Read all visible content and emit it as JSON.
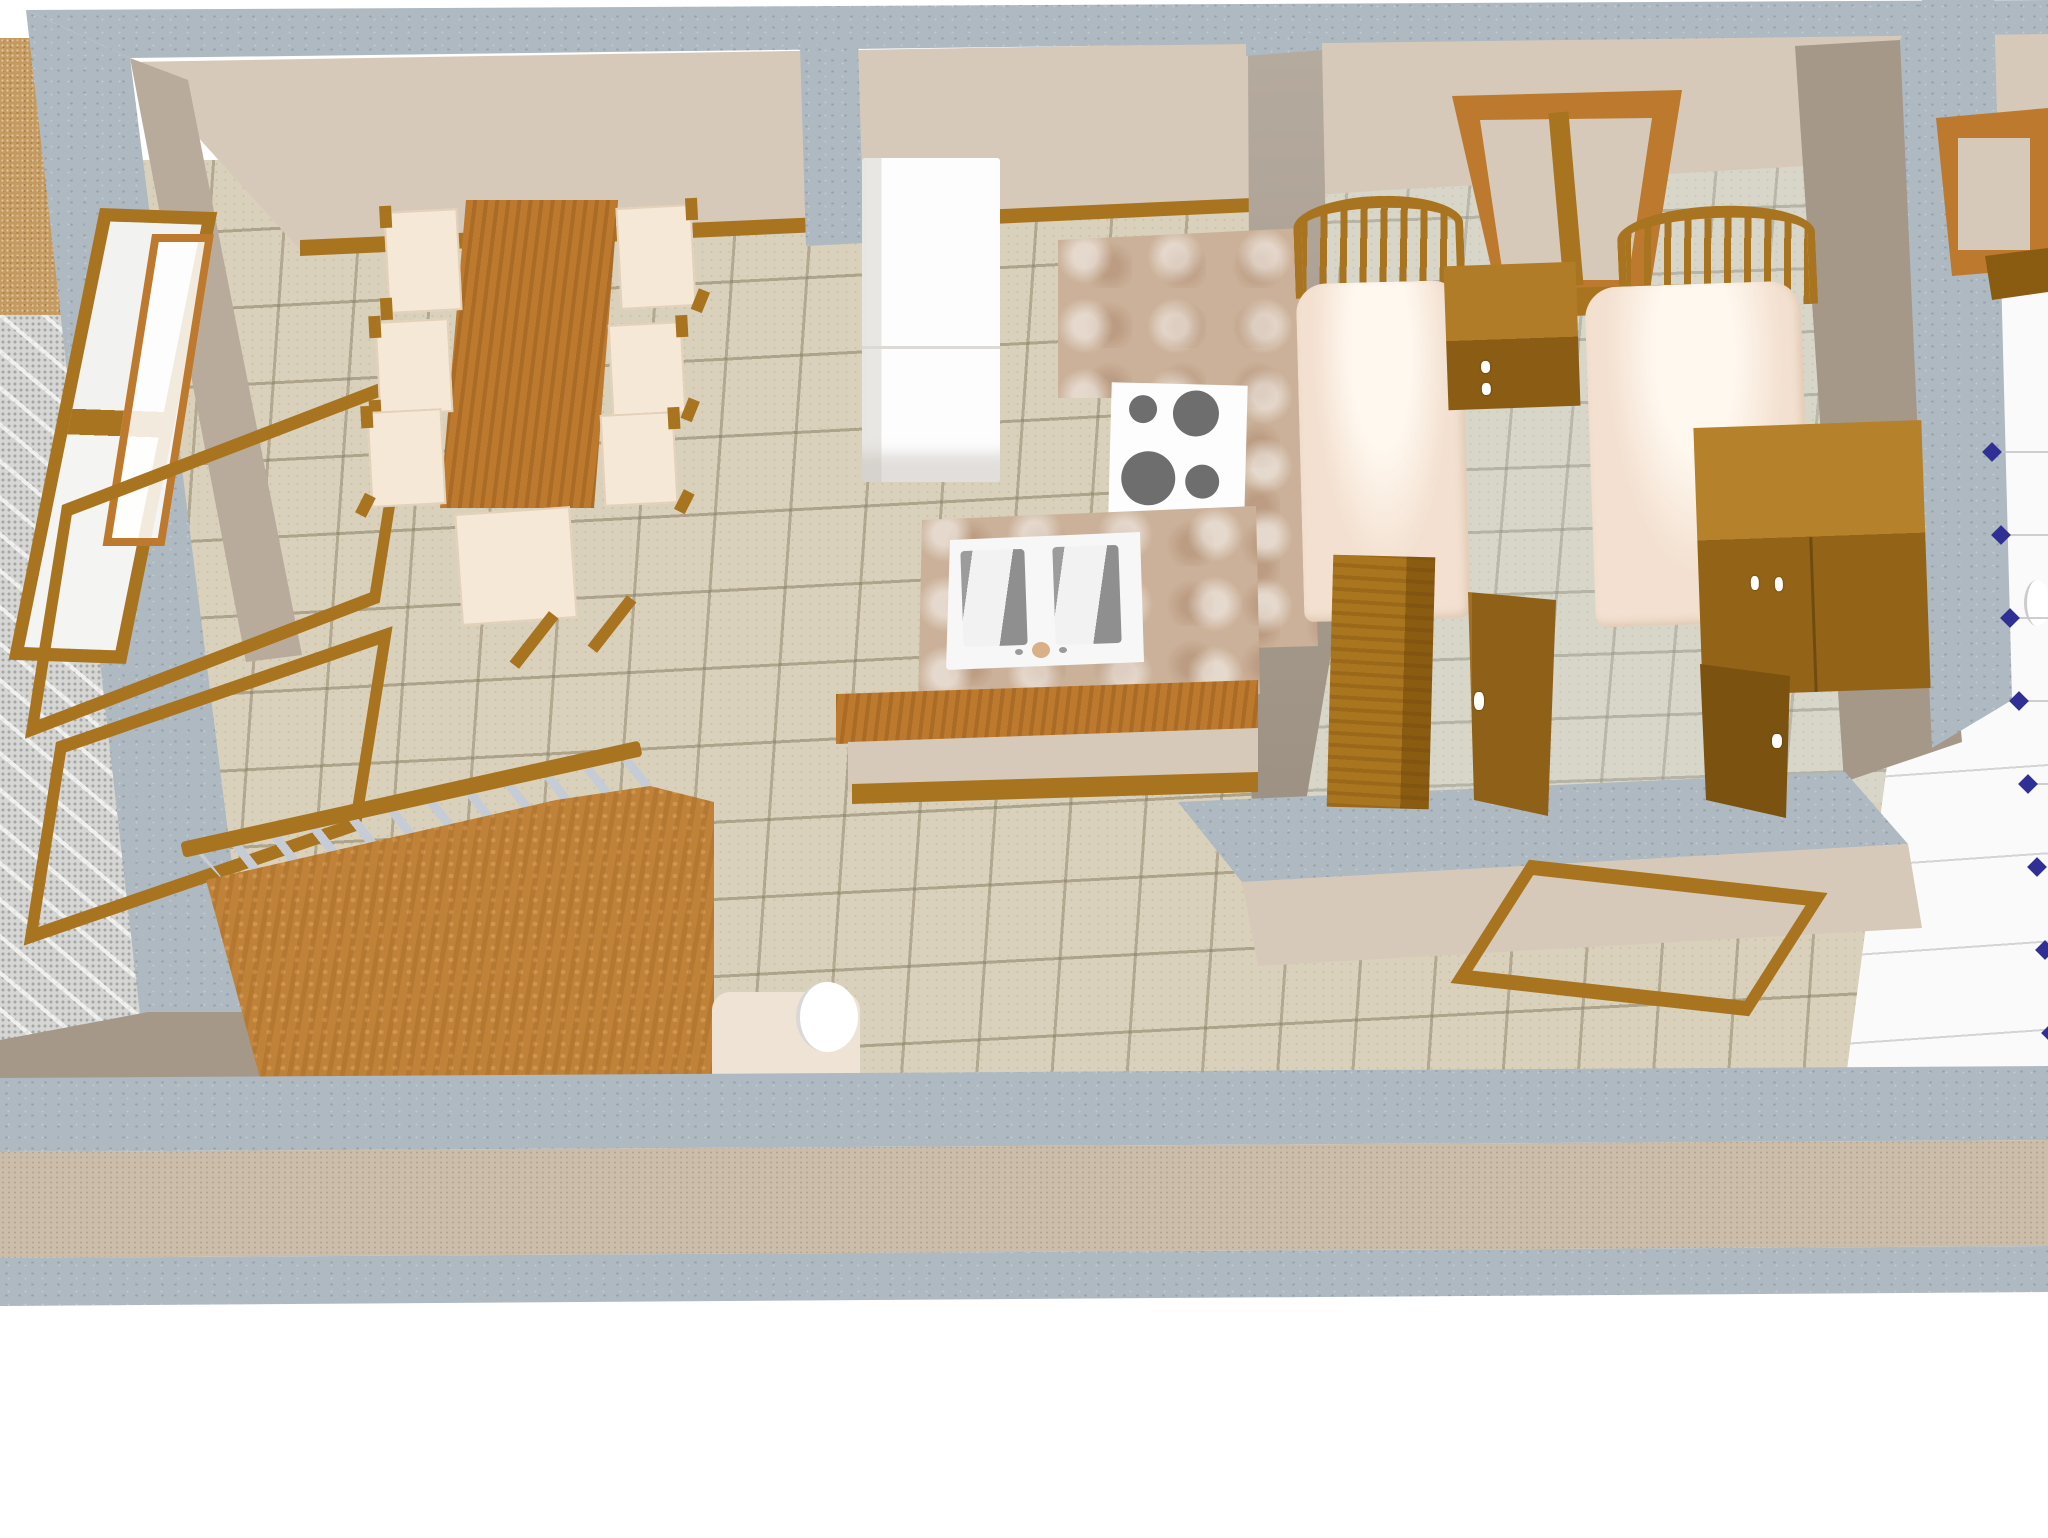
{
  "scene": {
    "kind": "3d-home-plan-render",
    "view": "aerial-oblique",
    "visible_text": "",
    "selection_markers": {
      "count": 8,
      "shape": "diamond"
    }
  },
  "palette": {
    "wall_band": "#aeb9c2",
    "wall_face": "#d7c9b9",
    "wall_side": "#b9ab9c",
    "wall_inner": "#a59889",
    "floor": "#d9d1bb",
    "floor_bedroom": "#d8d5c9",
    "floor_right_room": "#fafafa",
    "gravel": "#d6d6d4",
    "terrace": "#c59a60",
    "terrace_strip": "#cbbda9",
    "counter": "#cbb199",
    "wood": "#a9741f",
    "wood_light": "#bd7a2e",
    "wood_dark": "#8a5c12",
    "sofa": "#c08238",
    "slat": "#c6ccd6",
    "chair": "#f6e8d6",
    "bed": "#f3e0d0",
    "appliance_white": "#fdfdfd",
    "burner": "#6e6e6e",
    "marker": "#2f2f96"
  },
  "objects": {
    "dining_table": "dining-table",
    "dining_chair": "dining-chair",
    "window_left": "casement-window",
    "open_sash": "open-window-sash",
    "sofa": "wooden-sofa",
    "armchair": "armchair",
    "fridge": "refrigerator",
    "stove": "cooktop",
    "kitchen_counter": "kitchen-counter",
    "island": "island-counter",
    "sink": "double-basin-sink",
    "bar": "breakfast-bar",
    "bed_single": "single-bed",
    "bed_double": "double-bed",
    "nightstand": "nightstand",
    "chest": "chest-of-drawers",
    "wardrobe": "wardrobe",
    "bedroom_door": "bedroom-door-open",
    "closet_door": "closet-door",
    "hall_frame": "door-frame",
    "bedroom_window": "tilt-open-window",
    "right_window": "window",
    "white_fixture": "bathroom-fixture",
    "marker": "selection-marker"
  },
  "counts": {
    "dining_chairs": 6,
    "stove_burners": 4,
    "sink_basins": 2,
    "beds": 2,
    "open_window_sashes": 2,
    "selection_markers": 8
  }
}
